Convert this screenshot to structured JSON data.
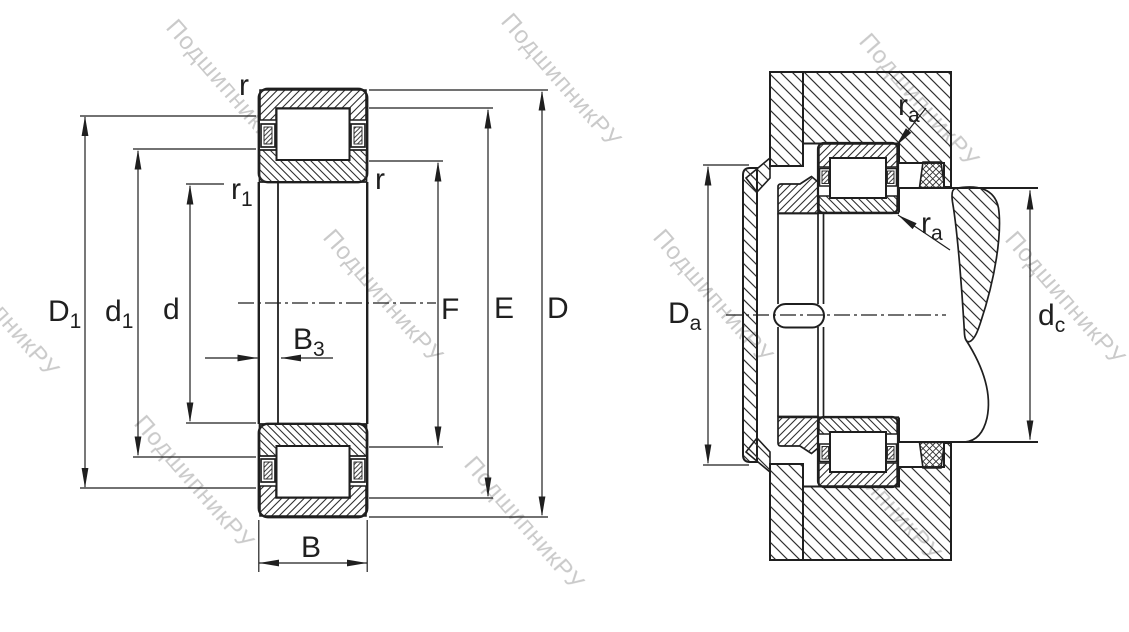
{
  "watermark": {
    "text": "ПодшипникРУ"
  },
  "left_view": {
    "labels": {
      "r_top": {
        "base": "r",
        "sub": ""
      },
      "r1": {
        "base": "r",
        "sub": "1"
      },
      "r_right": {
        "base": "r",
        "sub": ""
      },
      "D1": {
        "base": "D",
        "sub": "1"
      },
      "d1": {
        "base": "d",
        "sub": "1"
      },
      "d": {
        "base": "d",
        "sub": ""
      },
      "B3": {
        "base": "B",
        "sub": "3"
      },
      "B": {
        "base": "B",
        "sub": ""
      },
      "F": {
        "base": "F",
        "sub": ""
      },
      "E": {
        "base": "E",
        "sub": ""
      },
      "D": {
        "base": "D",
        "sub": ""
      }
    }
  },
  "right_view": {
    "labels": {
      "ra_top": {
        "base": "r",
        "sub": "a"
      },
      "ra_bottom": {
        "base": "r",
        "sub": "a"
      },
      "Da": {
        "base": "D",
        "sub": "a"
      },
      "dc": {
        "base": "d",
        "sub": "c"
      }
    }
  },
  "colors": {
    "line": "#1f1f1f",
    "hatch": "#2f2f2f",
    "watermark_gray": "#7a7a7a",
    "background": "#ffffff"
  }
}
